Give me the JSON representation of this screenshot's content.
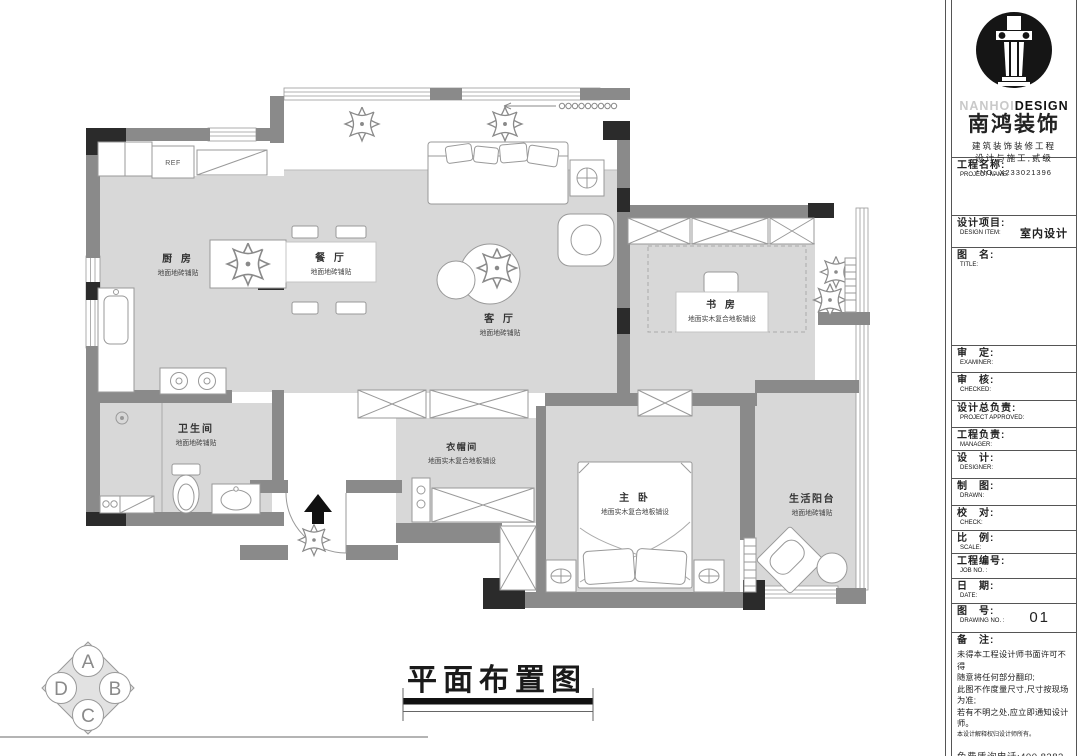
{
  "colors": {
    "floor": "#d8d8d8",
    "wall": "#8a8a8a",
    "column": "#2b2b2b",
    "paper": "#ffffff"
  },
  "plan": {
    "caption": "平面布置图",
    "fridge_label": "REF",
    "rooms": [
      {
        "id": "kitchen",
        "name": "厨 房",
        "finish": "地面地砖铺贴"
      },
      {
        "id": "dining",
        "name": "餐 厅",
        "finish": "地面地砖铺贴"
      },
      {
        "id": "living",
        "name": "客 厅",
        "finish": "地面地砖铺贴"
      },
      {
        "id": "study",
        "name": "书 房",
        "finish": "地面实木复合地板铺设"
      },
      {
        "id": "bathroom",
        "name": "卫生间",
        "finish": "地面地砖铺贴"
      },
      {
        "id": "cloakroom",
        "name": "衣帽间",
        "finish": "地面实木复合地板铺设"
      },
      {
        "id": "master",
        "name": "主 卧",
        "finish": "地面实木复合地板铺设"
      },
      {
        "id": "balcony",
        "name": "生活阳台",
        "finish": "地面地砖铺贴"
      }
    ],
    "direction_symbol": {
      "top": "A",
      "right": "B",
      "bottom": "C",
      "left": "D"
    }
  },
  "titleblock": {
    "brand": {
      "en_light": "NANHOI",
      "en_bold": "DESIGN",
      "cn": "南鸿装饰",
      "line1": "建筑装饰装修工程",
      "line2": "设计与施工,贰级",
      "no": "*NO: X233021396"
    },
    "rows": [
      {
        "cn": "工程名称:",
        "en": "PROJECT NAME:",
        "value": ""
      },
      {
        "cn": "设计项目:",
        "en": "DESIGN ITEM:",
        "value": "室内设计"
      },
      {
        "cn": "图　名:",
        "en": "TITLE:",
        "value": ""
      },
      {
        "cn": "审　定:",
        "en": "EXAMINER:",
        "value": ""
      },
      {
        "cn": "审　核:",
        "en": "CHECKED:",
        "value": ""
      },
      {
        "cn": "设计总负责:",
        "en": "PROJECT APPROVED:",
        "value": ""
      },
      {
        "cn": "工程负责:",
        "en": "MANAGER:",
        "value": ""
      },
      {
        "cn": "设　计:",
        "en": "DESIGNER:",
        "value": ""
      },
      {
        "cn": "制　图:",
        "en": "DRAWN:",
        "value": ""
      },
      {
        "cn": "校　对:",
        "en": "CHECK:",
        "value": ""
      },
      {
        "cn": "比　例:",
        "en": "SCALE:",
        "value": ""
      },
      {
        "cn": "工程编号:",
        "en": "JOB  NO. :",
        "value": ""
      },
      {
        "cn": "日　期:",
        "en": "DATE:",
        "value": ""
      },
      {
        "cn": "图　号:",
        "en": "DRAWING NO. :",
        "value": "01"
      }
    ],
    "notes": {
      "cn": "备　注:",
      "lines": [
        "未得本工程设计师书面许可不得",
        "随意将任何部分翻印;",
        "此图不作度量尺寸,尺寸按现场",
        "为准;",
        "若有不明之处,应立即通知设计",
        "师。"
      ],
      "small": "本设计解释权归设计师所有。",
      "phone": "免费质询电话:400 8383 168"
    }
  }
}
